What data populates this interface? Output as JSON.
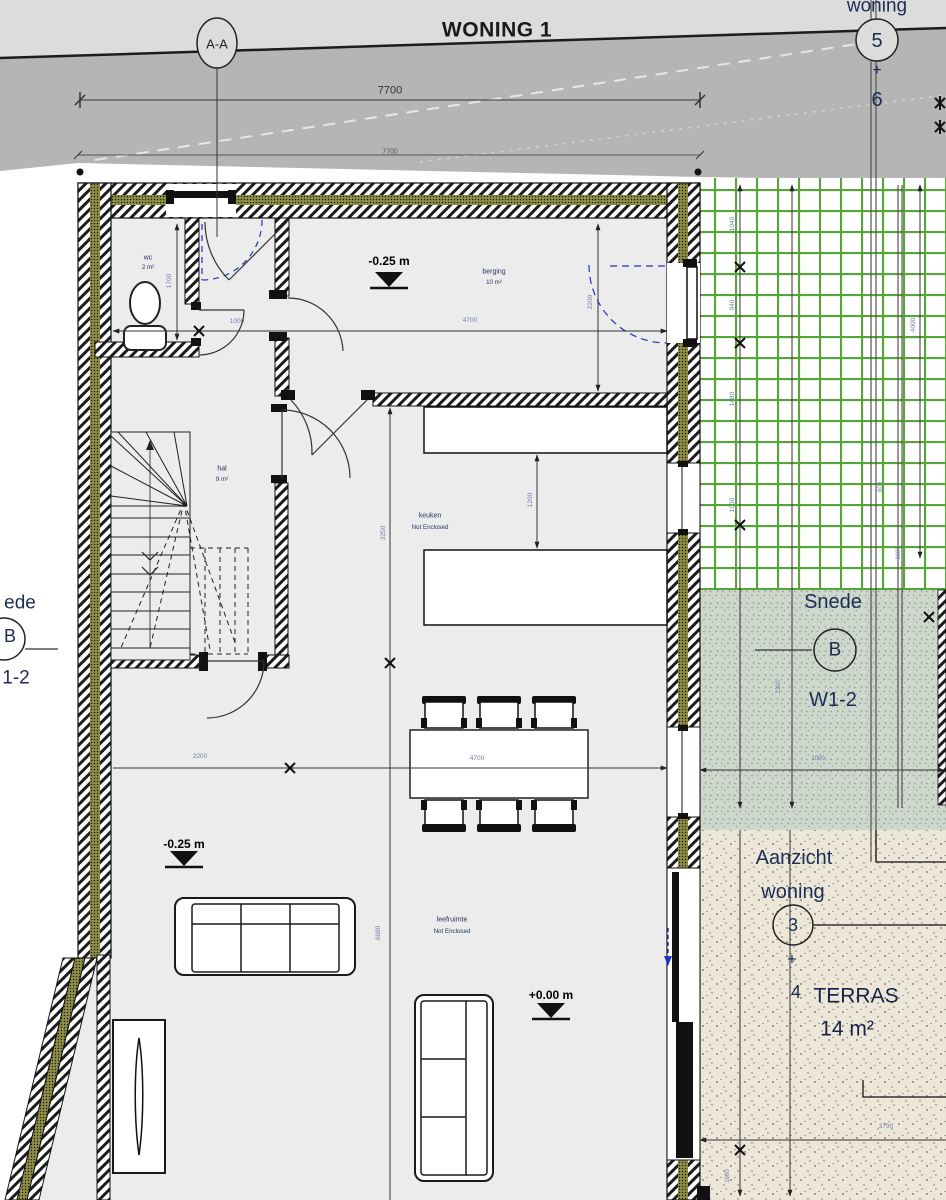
{
  "title": "WONING 1",
  "colors": {
    "road_light": "#dcdcdc",
    "road_dark": "#b5b5b5",
    "floor": "#ececec",
    "insulation_olive": "#8f8f45",
    "grid_green": "#55a636",
    "grass": "#cdd7cc",
    "terrace": "#ece7d8",
    "dim_text": "#707ea9",
    "label_navy": "#1d2c55",
    "door_dash_blue": "#2233bb"
  },
  "section_markers": {
    "aa": "A-A",
    "woning_top_label": "woning",
    "lot_num_5": "5",
    "lot_plus": "+",
    "lot_num_6": "6",
    "snede_label": "Snede",
    "snede_letter": "B",
    "snede_ref": "W1-2",
    "left_snede_partial": "ede",
    "left_snede_letter": "B",
    "left_snede_ref": "1-2",
    "aanzicht_label_1": "Aanzicht",
    "aanzicht_label_2": "woning",
    "aanzicht_num_3": "3",
    "aanzicht_plus": "+",
    "aanzicht_num_4": "4"
  },
  "rooms": {
    "wc": {
      "name": "wc",
      "area": "2 m²"
    },
    "berging": {
      "name": "berging",
      "area": "10 m²"
    },
    "hal": {
      "name": "hal",
      "area": "9 m²"
    },
    "keuken": {
      "name": "keuken",
      "note": "Not Enclosed"
    },
    "leefruimte": {
      "name": "leefruimte",
      "note": "Not Enclosed"
    },
    "terras": {
      "name": "TERRAS",
      "area": "14 m²"
    }
  },
  "levels": {
    "berging": "-0.25 m",
    "living": "-0.25 m",
    "terrace": "+0.00 m"
  },
  "dimensions": {
    "total_width_outer": "7700",
    "total_width_inner": "7700",
    "wc_height": "1700",
    "wc_width": "1000",
    "berging_width": "4700",
    "berging_height": "2200",
    "counter_gap": "1200",
    "keuken_depth": "3250",
    "table_span": "4700",
    "living_left": "2200",
    "living_depth": "6680",
    "grid_1": "1040",
    "grid_2": "940",
    "grid_3": "1480",
    "grid_4": "1000",
    "grid_total": "4000",
    "grid_5": "800",
    "grid_6": "1600",
    "grass_v": "1300",
    "grass_h": "1000",
    "terras_width": "3790",
    "terras_height": "1600"
  }
}
